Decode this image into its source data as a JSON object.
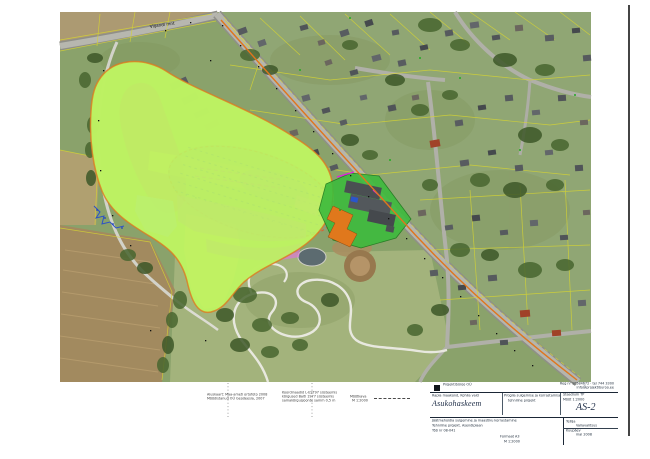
{
  "page": {
    "background": "#ffffff"
  },
  "map": {
    "road_label": "Viljandi mnt",
    "colors": {
      "boundary_orange": "#e0761c",
      "zone_lime": "#bdf263",
      "zone_salmon": "#e6897a",
      "zone_yellow": "#f0e75e",
      "zone_magenta": "#e46ee4",
      "zone_pink": "#f0a0c0",
      "zone_lightblue": "#aadcf2",
      "mound_grey": "#8e978f",
      "mound_purple": "#a98cc9",
      "mound_outline": "#df5f28",
      "plot_green": "#3dbb3d",
      "building_grey": "#4a4f52",
      "building_orange": "#e0781c",
      "parcel_yellow": "#d6d432",
      "hatch_blue": "#2b50c8"
    }
  },
  "notes": {
    "block_a": {
      "line1": "Aluskaart: Maa-ameti ortofoto 2008",
      "line2": "Mõõdistanud OÜ Geodeesia, 2007"
    },
    "block_b": {
      "line1": "Koordinaadid L-EST97 süsteemis",
      "line2": "kõrgused Balti 1977 süsteemis",
      "line3": "samakõrgusjoonte samm 0,5 m"
    },
    "block_c": {
      "line1": "Mõõtkava",
      "line2": "M 1:2000"
    }
  },
  "titleblock": {
    "company": "Projektibüroo OÜ",
    "reg_line": "Reg nr 10584672 · tel 744 3300",
    "contact_line": "info@projektiburoo.ee",
    "left_label": "Rapla maakond, Kohila vald",
    "mid_line1": "Prügila sulgemise ja korrastamise",
    "mid_line2": "tehniline projekt",
    "right_label1": "Staadium  TP",
    "right_label2": "Mõõt  1:2000",
    "title_main": "Asukohaskeem",
    "sheet_code": "AS-2",
    "bottom_left1": "Jäätmehoidla sulgemine ja maastiku korrastamine",
    "bottom_left2": "Tehniline projekt. Asendiplaan",
    "bottom_left3": "Töö nr 08-041",
    "bottom_center1": "Formaat A3",
    "bottom_center2": "M 1:2000",
    "tellija_label": "Tellija",
    "tellija_value": "Vallavalitsus",
    "date_label": "Kuupäev",
    "date_value": "mai 2008"
  }
}
